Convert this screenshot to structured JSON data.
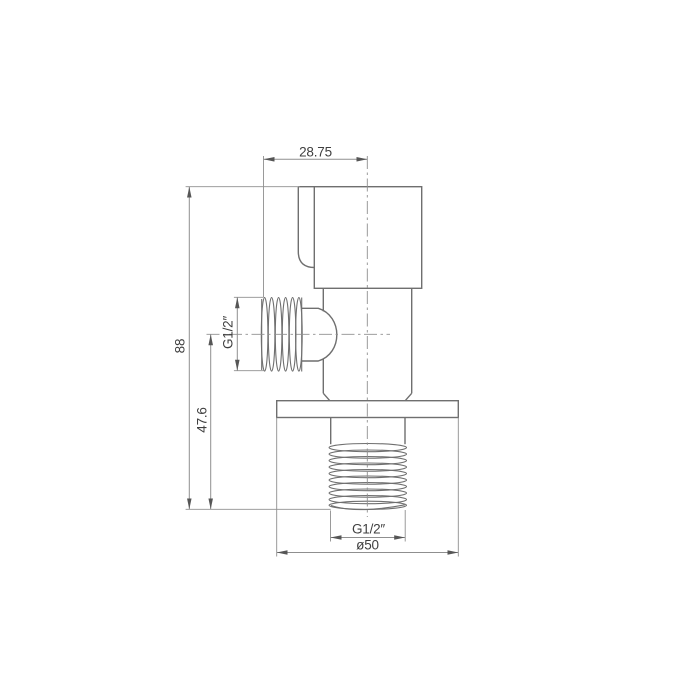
{
  "drawing": {
    "labels": {
      "top_width": "28.75",
      "overall_height": "88",
      "outlet_center_height": "47.6",
      "side_thread_size": "G1/2″",
      "bottom_thread_size": "G1/2″",
      "flange_diameter": "ø50"
    }
  },
  "colors": {
    "background": "#ffffff",
    "part_line": "#6f6f6f",
    "dim_line": "#8f8f8f",
    "center_line": "#8f8f8f",
    "text": "#3f3f3f",
    "arrow": "#565656"
  }
}
